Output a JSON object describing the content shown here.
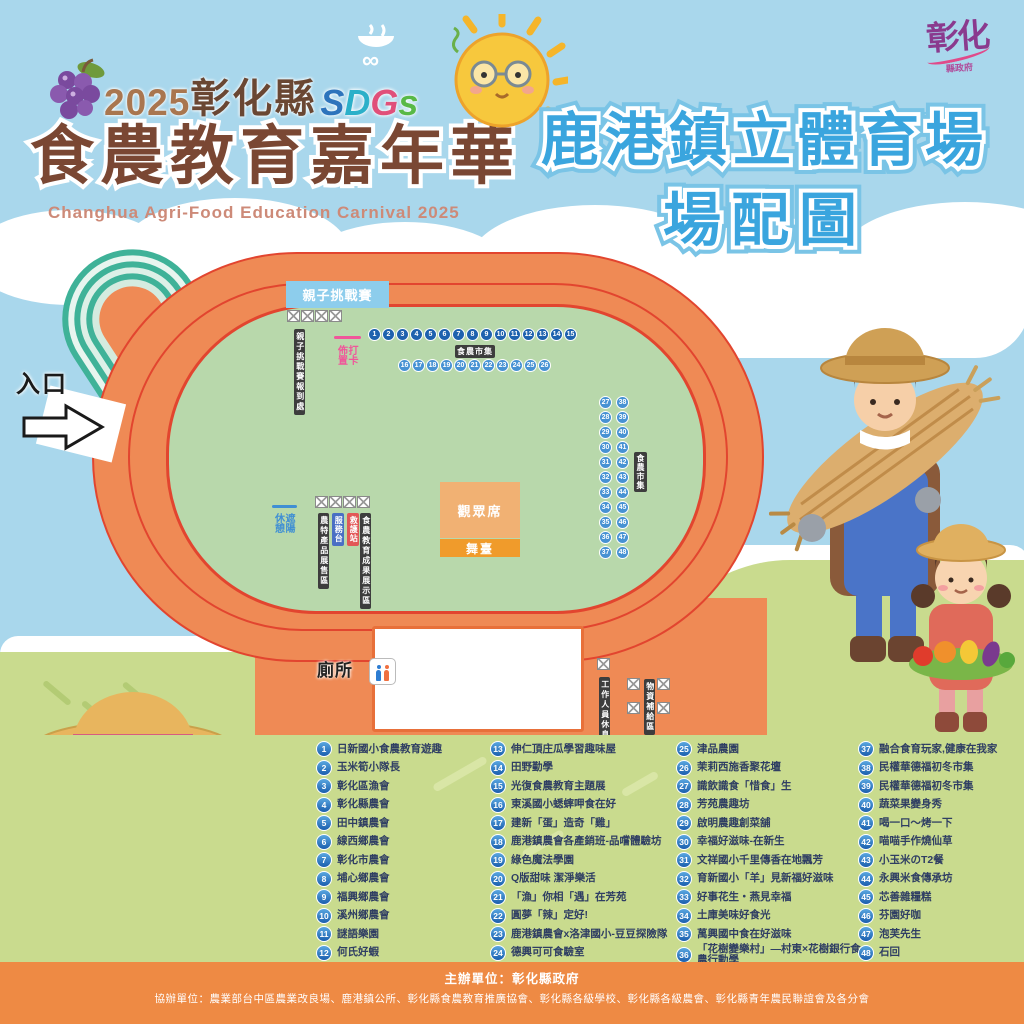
{
  "header": {
    "brand_year": "2025",
    "brand_region": "彰化縣",
    "sdgs_letters": [
      "S",
      "D",
      "G",
      "s"
    ],
    "main_title": "食農教育嘉年華",
    "subtitle_en": "Changhua Agri-Food Education Carnival 2025",
    "venue_line1": "鹿港鎮立體育場",
    "venue_line2": "場配圖",
    "gov_logo_main": "彰化",
    "gov_logo_sub": "縣政府"
  },
  "map": {
    "entrance_label": "入口",
    "challenge_banner": "親子挑戰賽",
    "challenge_checkin_label": "親子挑戰賽報到處",
    "photo_deco_pink": "打卡佈置",
    "photo_deco_blue": "遮陽休憩",
    "market_label_top": "食農市集",
    "market_label_right": "食農市集",
    "spectator_label": "觀眾席",
    "stage_label": "舞臺",
    "toilet_label": "廁所",
    "booth_area_label_1": "農特產品展售區",
    "service_banner_blue": "服務台",
    "aid_banner_red": "救護站",
    "booth_area_label_2": "食農教育成果展示區",
    "staff_area_label": "工作人員休息區",
    "supply_area_label": "物資補給區",
    "numbers": {
      "row1": [
        1,
        2,
        3,
        4,
        5,
        6,
        7,
        8,
        9,
        10,
        11,
        12,
        13,
        14,
        15
      ],
      "row2": [
        16,
        17,
        18,
        19,
        20,
        21,
        22,
        23,
        24,
        25,
        26
      ],
      "colA": [
        27,
        28,
        29,
        30,
        31,
        32,
        33,
        34,
        35,
        36,
        37
      ],
      "colB": [
        38,
        39,
        40,
        41,
        42,
        43,
        44,
        45,
        46,
        47,
        48
      ]
    }
  },
  "legend": {
    "col1": [
      {
        "n": "1",
        "label": "日新國小食農教育遊趣"
      },
      {
        "n": "2",
        "label": "玉米筍小隊長"
      },
      {
        "n": "3",
        "label": "彰化區漁會"
      },
      {
        "n": "4",
        "label": "彰化縣農會"
      },
      {
        "n": "5",
        "label": "田中鎮農會"
      },
      {
        "n": "6",
        "label": "線西鄉農會"
      },
      {
        "n": "7",
        "label": "彰化市農會"
      },
      {
        "n": "8",
        "label": "埔心鄉農會"
      },
      {
        "n": "9",
        "label": "福興鄉農會"
      },
      {
        "n": "10",
        "label": "溪州鄉農會"
      },
      {
        "n": "11",
        "label": "謎語樂園"
      },
      {
        "n": "12",
        "label": "何氏好蝦"
      }
    ],
    "col2": [
      {
        "n": "13",
        "label": "伸仁頂庄瓜學習趣味屋"
      },
      {
        "n": "14",
        "label": "田野勤學"
      },
      {
        "n": "15",
        "label": "光復食農教育主題展"
      },
      {
        "n": "16",
        "label": "東溪國小蟋蟀呷食在好"
      },
      {
        "n": "17",
        "label": "建新「蛋」造奇「雞」"
      },
      {
        "n": "18",
        "label": "鹿港鎮農會各產銷班-品嚐體驗坊"
      },
      {
        "n": "19",
        "label": "綠色魔法學園"
      },
      {
        "n": "20",
        "label": "Q版甜味 潔淨樂活"
      },
      {
        "n": "21",
        "label": "「漁」你相「遇」在芳苑"
      },
      {
        "n": "22",
        "label": "圓夢「辣」定好!"
      },
      {
        "n": "23",
        "label": "鹿港鎮農會x洛津國小-豆豆探險隊"
      },
      {
        "n": "24",
        "label": "德興可可食驗室"
      }
    ],
    "col3": [
      {
        "n": "25",
        "label": "津品農園"
      },
      {
        "n": "26",
        "label": "茉莉西施香聚花壇"
      },
      {
        "n": "27",
        "label": "識飲識食「惜食」生"
      },
      {
        "n": "28",
        "label": "芳苑農趣坊"
      },
      {
        "n": "29",
        "label": "啟明農趣創菜舖"
      },
      {
        "n": "30",
        "label": "幸福好滋味-在新生"
      },
      {
        "n": "31",
        "label": "文祥國小千里傳香在地飄芳"
      },
      {
        "n": "32",
        "label": "育新國小「羊」見新福好滋味"
      },
      {
        "n": "33",
        "label": "好事花生・燕見幸福"
      },
      {
        "n": "34",
        "label": "土庫美味好食光"
      },
      {
        "n": "35",
        "label": "萬興國中食在好滋味"
      },
      {
        "n": "36",
        "label": "「花樹變樂村」—村東×花樹銀行食農行動學"
      }
    ],
    "col4": [
      {
        "n": "37",
        "label": "融合食育玩家,健康在我家"
      },
      {
        "n": "38",
        "label": "民權華德福初冬市集"
      },
      {
        "n": "39",
        "label": "民權華德福初冬市集"
      },
      {
        "n": "40",
        "label": "蔬菜果變身秀"
      },
      {
        "n": "41",
        "label": "喝一口～烤一下"
      },
      {
        "n": "42",
        "label": "喵喵手作燒仙草"
      },
      {
        "n": "43",
        "label": "小玉米のT2餐"
      },
      {
        "n": "44",
        "label": "永興米食傳承坊"
      },
      {
        "n": "45",
        "label": "芯善雜糧糕"
      },
      {
        "n": "46",
        "label": "芬園好咖"
      },
      {
        "n": "47",
        "label": "泡芙先生"
      },
      {
        "n": "48",
        "label": "石回"
      }
    ]
  },
  "footer": {
    "organizer": "主辦單位：彰化縣政府",
    "co_organizer": "協辦單位：農業部台中區農業改良場、鹿港鎮公所、彰化縣食農教育推廣協會、彰化縣各級學校、彰化縣各級農會、彰化縣青年農民聯誼會及各分會"
  },
  "colors": {
    "sky": "#a9d7ec",
    "infield_green": "#b8d8ab",
    "track_orange": "#ef8a55",
    "track_red_line": "#e2452f",
    "legend_bg": "#c9db8e",
    "footer_orange": "#ee8a44",
    "title_brown": "#7a4733",
    "venue_blue": "#3aa5de",
    "number_blue_dark": "#1e62ae",
    "number_blue_light": "#4792d3",
    "photo_pink": "#f0569a"
  }
}
